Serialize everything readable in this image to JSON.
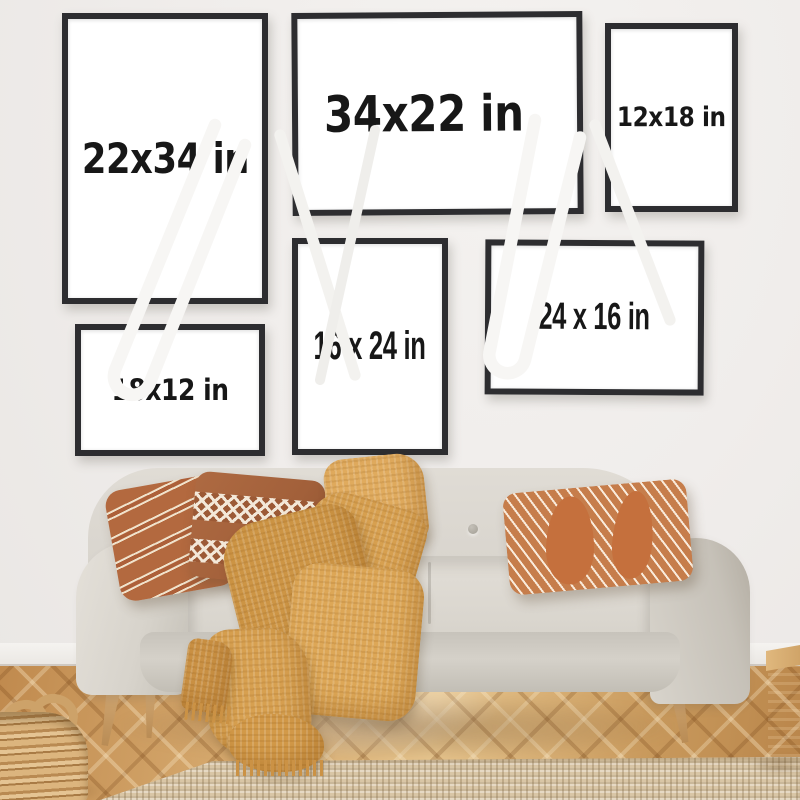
{
  "frames": [
    {
      "id": "frame-22x34",
      "label": "22x34 in",
      "orientation": "portrait"
    },
    {
      "id": "frame-34x22",
      "label": "34x22 in",
      "orientation": "landscape"
    },
    {
      "id": "frame-12x18",
      "label": "12x18 in",
      "orientation": "portrait"
    },
    {
      "id": "frame-16x24",
      "label": "16 x 24 in",
      "orientation": "portrait"
    },
    {
      "id": "frame-24x16",
      "label": "24 x 16 in",
      "orientation": "landscape"
    },
    {
      "id": "frame-18x12",
      "label": "18x12 in",
      "orientation": "landscape"
    }
  ],
  "colors": {
    "wall": "#f0edeb",
    "frame_border": "#2d2d30",
    "frame_canvas": "#ffffff",
    "label_text": "#171717",
    "sofa_fabric": "#d9d5ce",
    "throw_blanket": "#d7a050",
    "pillow_terracotta": "#b3693f",
    "pillow_rust": "#a2603a",
    "pillow_stripe_cream": "#f0e2cb",
    "floor_wood": "#cfa063",
    "rug": "#d9c6a6",
    "table_wood": "#ddb77f",
    "hairpin_legs": "#f7f6f4",
    "bowl": "#5e3b20",
    "basket": "#c79c63",
    "wood_cube": "#b3824a",
    "baseboard": "#f5f3f0"
  }
}
